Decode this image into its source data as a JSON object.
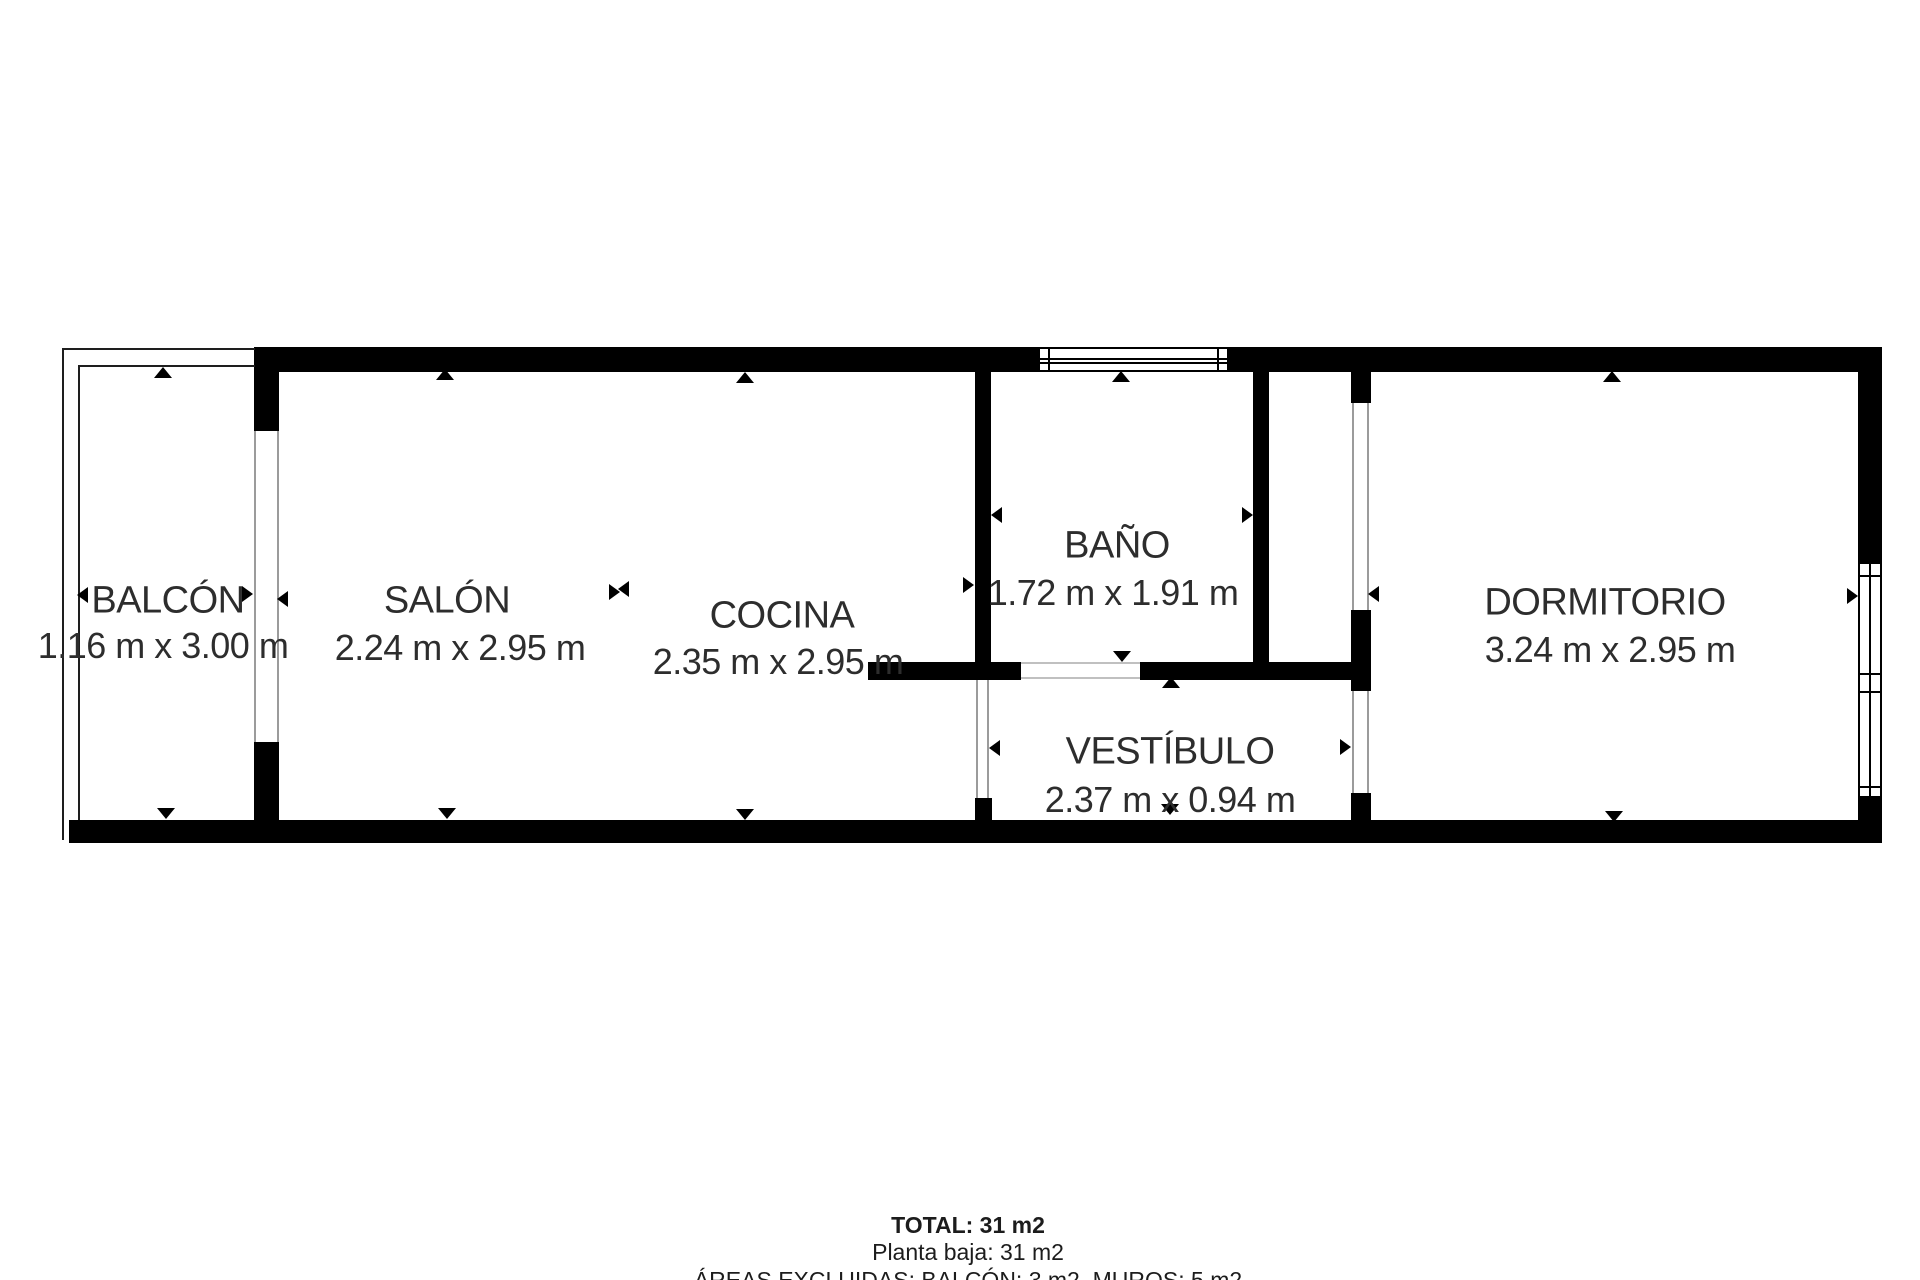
{
  "plan": {
    "rooms": {
      "balcon": {
        "name": "BALCÓN",
        "dims": "1.16 m x 3.00 m"
      },
      "salon": {
        "name": "SALÓN",
        "dims": "2.24 m x 2.95 m"
      },
      "cocina": {
        "name": "COCINA",
        "dims": "2.35 m x 2.95 m"
      },
      "bano": {
        "name": "BAÑO",
        "dims": "1.72 m x 1.91 m"
      },
      "vestibulo": {
        "name": "VESTÍBULO",
        "dims": "2.37 m x 0.94 m"
      },
      "dormitorio": {
        "name": "DORMITORIO",
        "dims": "3.24 m x 2.95 m"
      }
    },
    "summary": {
      "total": "TOTAL: 31 m2",
      "floor": "Planta baja: 31 m2",
      "excluded": "ÁREAS EXCLUIDAS: BALCÓN: 3 m2, MUROS: 5 m2"
    },
    "colors": {
      "wall": "#000000",
      "text": "#2d2d2d",
      "opening_line": "#9b9b9b",
      "background": "#ffffff"
    }
  }
}
